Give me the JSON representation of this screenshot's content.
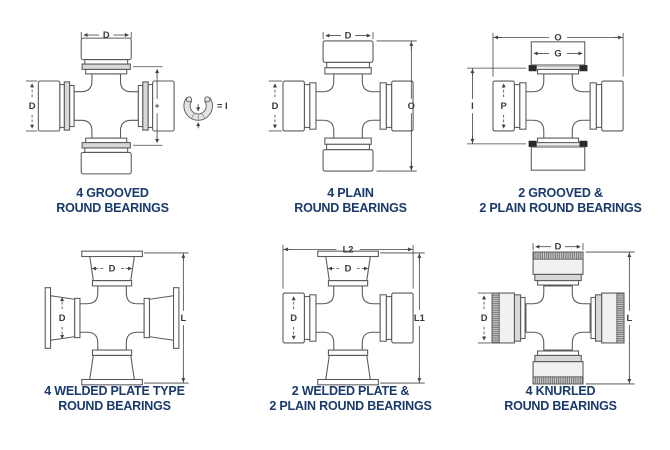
{
  "colors": {
    "background": "#ffffff",
    "caption_text": "#1a3a6c",
    "part_outline": "#595a5c",
    "dimension_lines": "#434345",
    "groove_fill": "#d7d8d9",
    "snap_ring_groove_mark": "#2a2a2c"
  },
  "diagrams": [
    {
      "name": "4-grooved-round-bearings",
      "caption": [
        "4 GROOVED",
        "ROUND BEARINGS"
      ],
      "dims": {
        "top": "D",
        "left": "D",
        "mid": "+",
        "ring_equals": "= I"
      }
    },
    {
      "name": "4-plain-round-bearings",
      "caption": [
        "4 PLAIN",
        "ROUND BEARINGS"
      ],
      "dims": {
        "top": "D",
        "left": "D",
        "right": "O"
      }
    },
    {
      "name": "2-grooved-2-plain-round-bearings",
      "caption": [
        "2 GROOVED &",
        "2 PLAIN ROUND BEARINGS"
      ],
      "dims": {
        "top": "O",
        "cap_top": "G",
        "left": "I",
        "cap_left": "P"
      }
    },
    {
      "name": "4-welded-plate-type-round-bearings",
      "caption": [
        "4 WELDED PLATE TYPE",
        "ROUND BEARINGS"
      ],
      "dims": {
        "cap_top": "D",
        "cap_left": "D",
        "right": "L"
      }
    },
    {
      "name": "2-welded-plate-2-plain-round-bearings",
      "caption": [
        "2 WELDED PLATE &",
        "2 PLAIN ROUND BEARINGS"
      ],
      "dims": {
        "top": "L2",
        "cap_top": "D",
        "cap_left": "D",
        "right": "L1"
      }
    },
    {
      "name": "4-knurled-round-bearings",
      "caption": [
        "4 KNURLED",
        "ROUND BEARINGS"
      ],
      "dims": {
        "top": "D",
        "left": "D",
        "right": "L"
      }
    }
  ]
}
